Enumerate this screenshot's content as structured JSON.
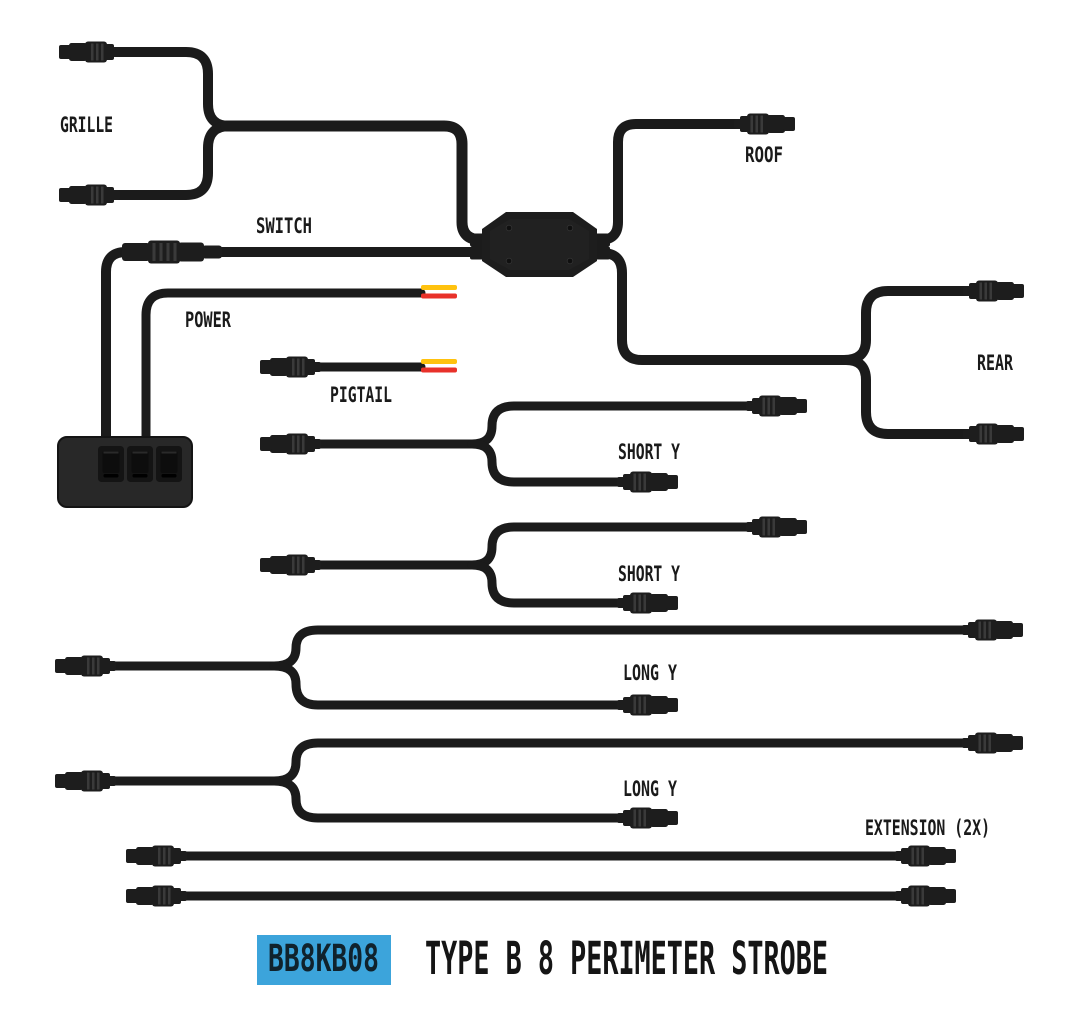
{
  "diagram": {
    "labels": {
      "grille": "GRILLE",
      "switch": "SWITCH",
      "power": "POWER",
      "pigtail": "PIGTAIL",
      "roof": "ROOF",
      "rear": "REAR",
      "short_y_1": "SHORT Y",
      "short_y_2": "SHORT Y",
      "long_y_1": "LONG Y",
      "long_y_2": "LONG Y",
      "extension": "EXTENSION (2X)"
    },
    "footer": {
      "part_number": "BB8KB08",
      "title": "TYPE B 8 PERIMETER STROBE"
    },
    "colors": {
      "cable_black": "#1b1b1b",
      "label_text": "#1a1a1a",
      "title_text": "#151515",
      "badge_bg": "#3CA4DB",
      "badge_text": "#10222C",
      "wire_yellow": "#FFC20E",
      "wire_red": "#E8312A"
    }
  }
}
